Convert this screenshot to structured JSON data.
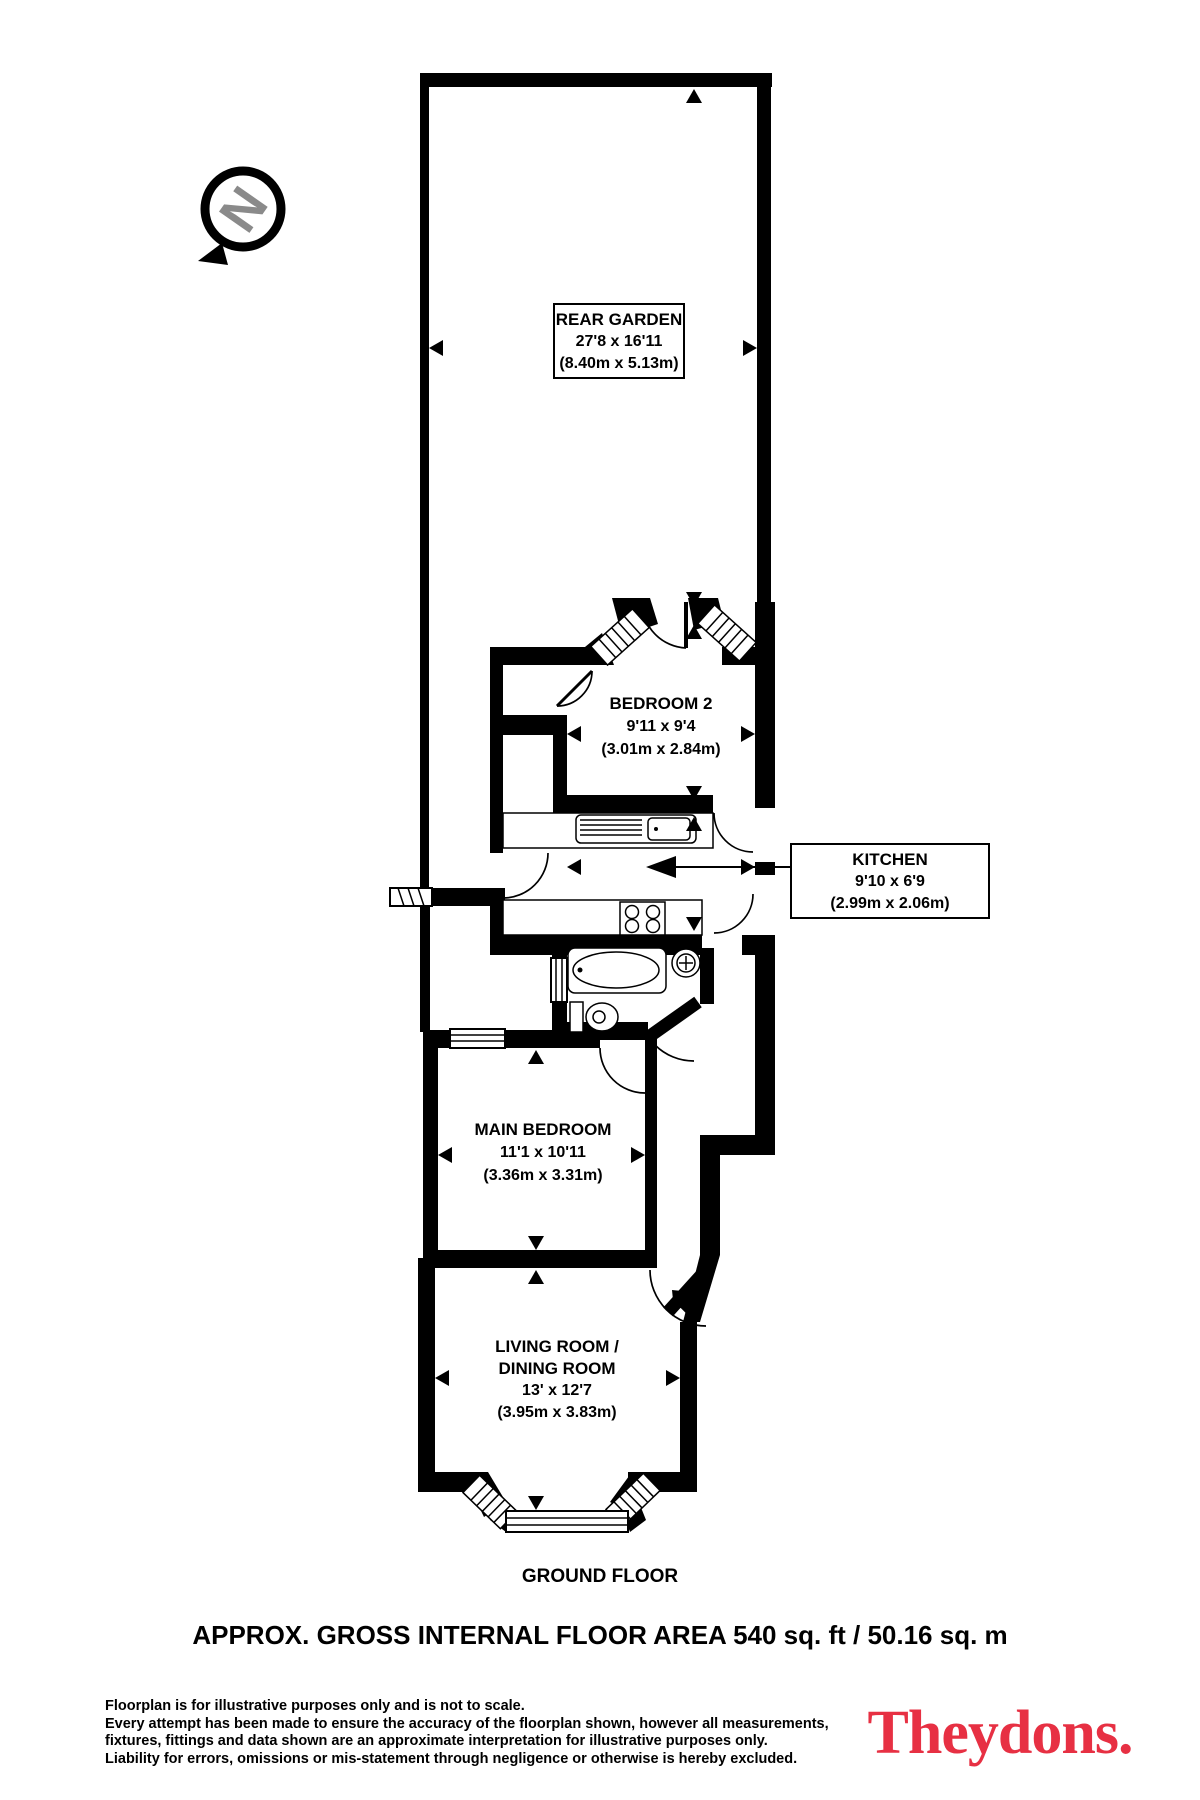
{
  "compass": {
    "letter": "N"
  },
  "rooms": {
    "rear_garden": {
      "name": "REAR GARDEN",
      "imperial": "27'8 x 16'11",
      "metric": "(8.40m x 5.13m)"
    },
    "bedroom2": {
      "name": "BEDROOM 2",
      "imperial": "9'11 x 9'4",
      "metric": "(3.01m x 2.84m)"
    },
    "kitchen": {
      "name": "KITCHEN",
      "imperial": "9'10 x 6'9",
      "metric": "(2.99m x 2.06m)"
    },
    "main_bedroom": {
      "name": "MAIN BEDROOM",
      "imperial": "11'1 x 10'11",
      "metric": "(3.36m x 3.31m)"
    },
    "living_dining": {
      "name_line1": "LIVING ROOM /",
      "name_line2": "DINING ROOM",
      "imperial": "13' x 12'7",
      "metric": "(3.95m x 3.83m)"
    }
  },
  "footer": {
    "floor_label": "GROUND FLOOR",
    "area_summary": "APPROX. GROSS INTERNAL FLOOR AREA 540 sq. ft / 50.16 sq. m",
    "disclaimer": [
      "Floorplan is for illustrative purposes only and is not to scale.",
      "Every attempt has been made to ensure the accuracy of the floorplan shown, however all measurements,",
      "fixtures, fittings and data shown are an approximate interpretation for illustrative purposes only.",
      "Liability for errors, omissions or mis-statement through negligence or otherwise is hereby excluded."
    ],
    "brand": {
      "name": "Theydons.",
      "color": "#e73043"
    }
  }
}
